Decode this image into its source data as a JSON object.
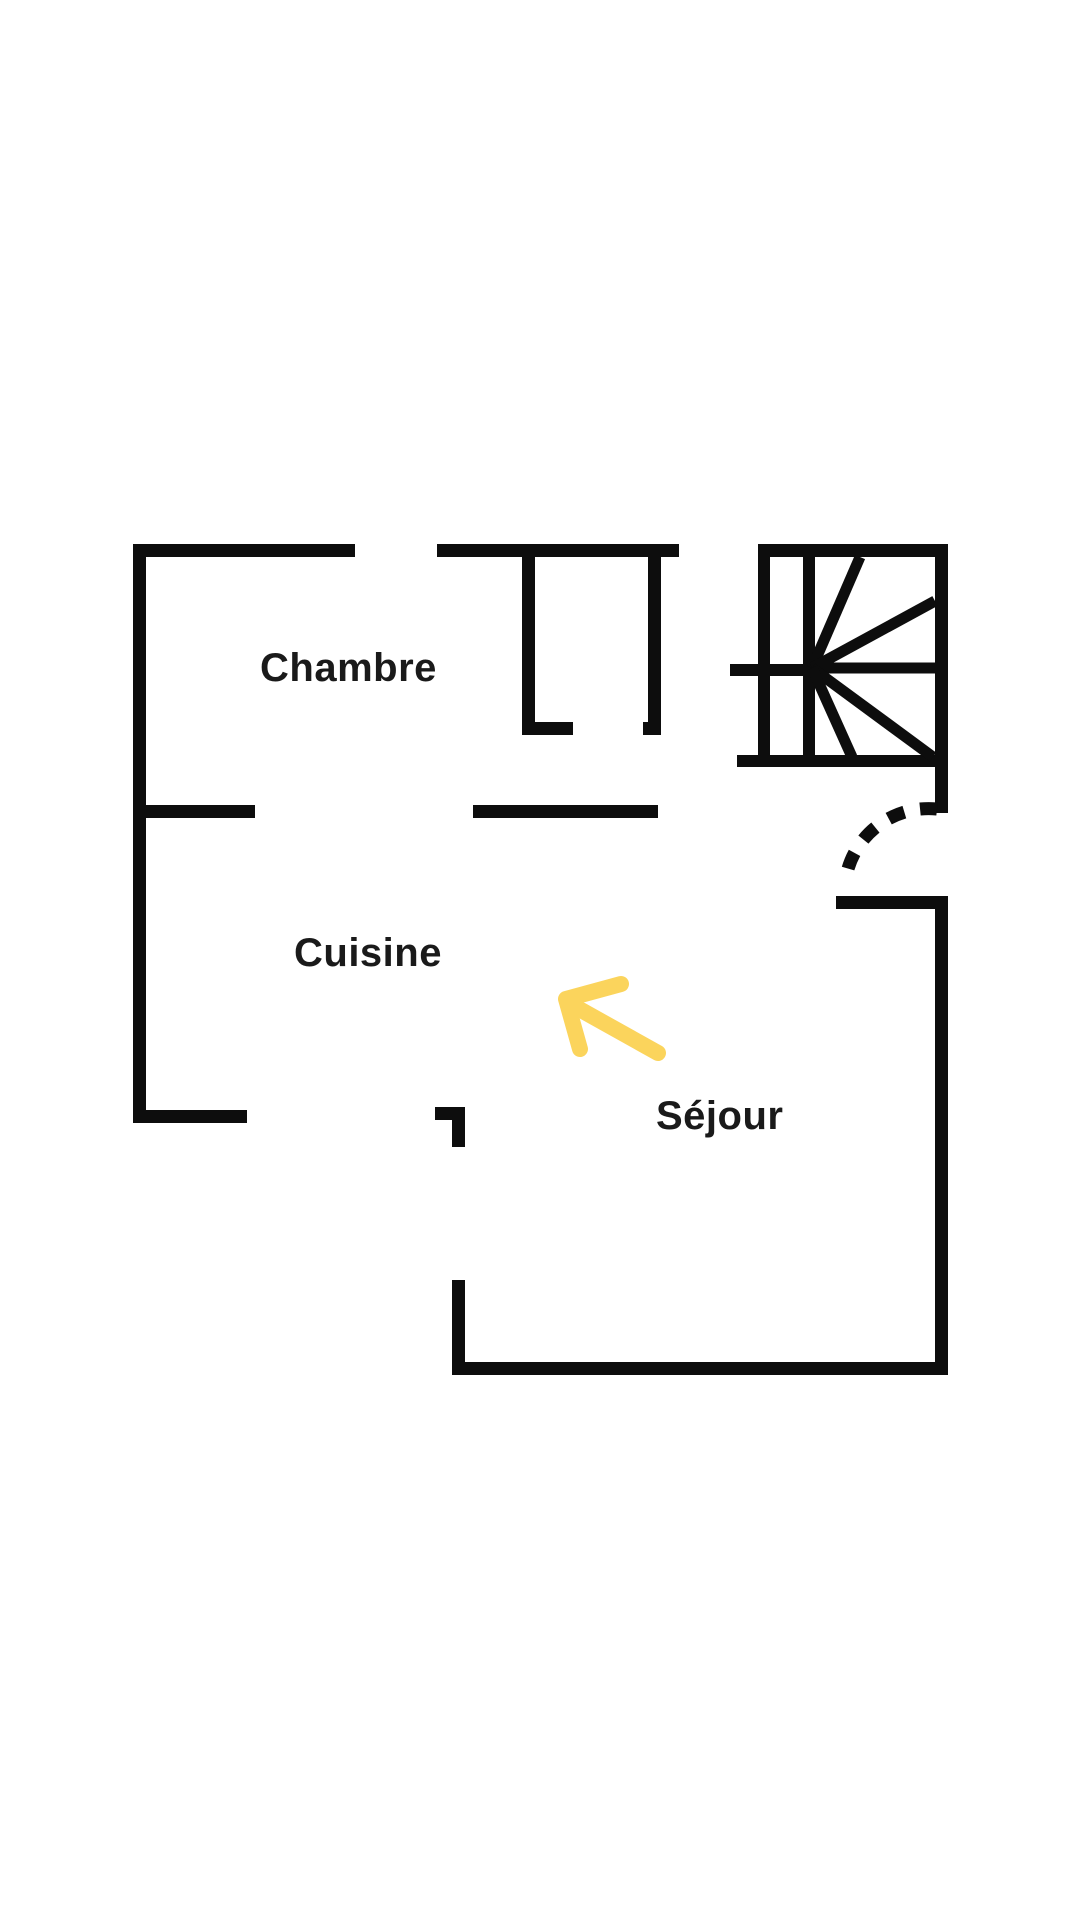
{
  "plan": {
    "rooms": [
      {
        "id": "chambre",
        "label": "Chambre"
      },
      {
        "id": "cuisine",
        "label": "Cuisine"
      },
      {
        "id": "sejour",
        "label": "Séjour"
      }
    ],
    "symbols": [
      {
        "id": "staircase",
        "name": "staircase-symbol"
      },
      {
        "id": "door-swing",
        "name": "door-swing-arc"
      },
      {
        "id": "arrow",
        "name": "direction-arrow"
      }
    ]
  },
  "colors": {
    "background": "#ffffff",
    "wall": "#0d0d0d",
    "label_text": "#1a1a1a",
    "arrow_accent": "#fbd45c"
  }
}
